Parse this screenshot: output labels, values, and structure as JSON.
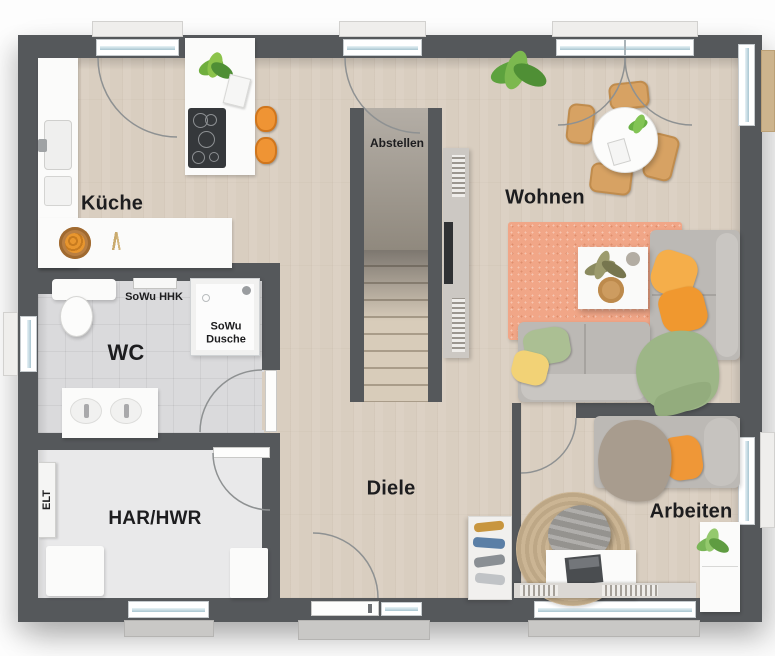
{
  "plan": {
    "rooms": {
      "kueche": "Küche",
      "wc": "WC",
      "har_hwr": "HAR/HWR",
      "diele": "Diele",
      "wohnen": "Wohnen",
      "arbeiten": "Arbeiten",
      "abstellen": "Abstellen"
    },
    "annotations": {
      "elt": "ELT",
      "sowu_hhk": "SoWu HHK",
      "sowu_dusche": "SoWu\nDusche"
    },
    "colors": {
      "wall": "#55585b",
      "wood_floor": "#d9cec0",
      "tile_wc": "#dadadc",
      "tile_har": "#e9e9ea",
      "living_rug": "#f1a687",
      "office_rug": "#c9b392",
      "accent_orange": "#f0982f",
      "pillow_yellow": "#f2d276",
      "pillow_green": "#abbf93",
      "blanket_green": "#9db687",
      "chair_tan": "#d7a263",
      "sofa_gray": "#bcb9b5"
    }
  }
}
